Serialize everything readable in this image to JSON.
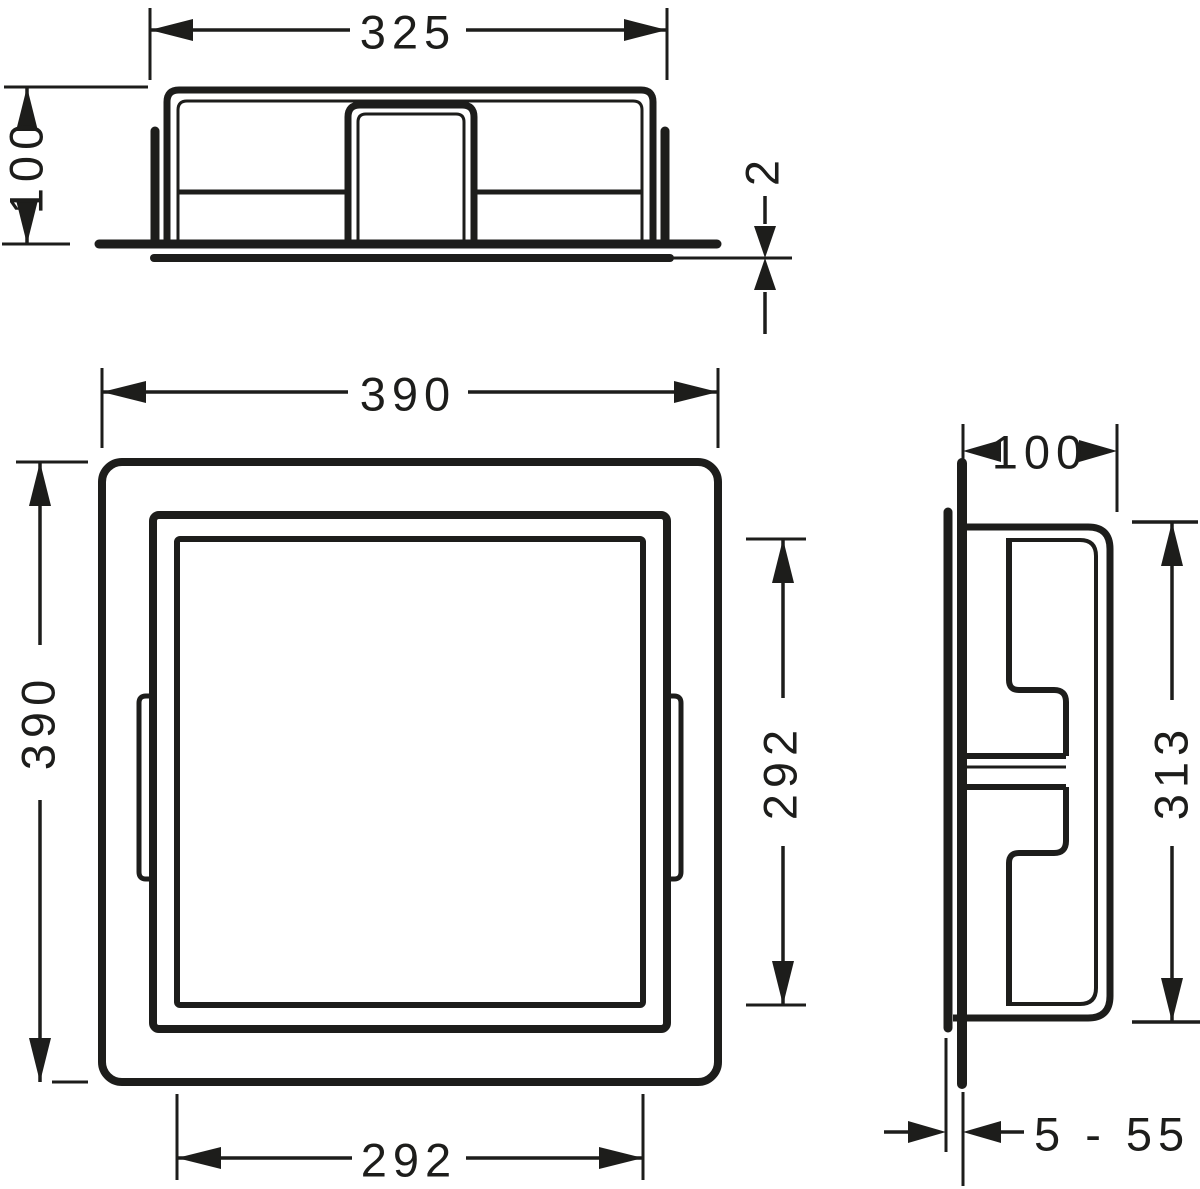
{
  "drawing": {
    "background": "#ffffff",
    "line_color": "#1d1d1b",
    "dimensions": {
      "top_width": "325",
      "top_depth": "100",
      "trim_thickness": "2",
      "front_width": "390",
      "front_height": "390",
      "opening_height": "292",
      "opening_width": "292",
      "side_depth": "100",
      "side_height": "313",
      "tile_range": "5 - 55"
    }
  }
}
